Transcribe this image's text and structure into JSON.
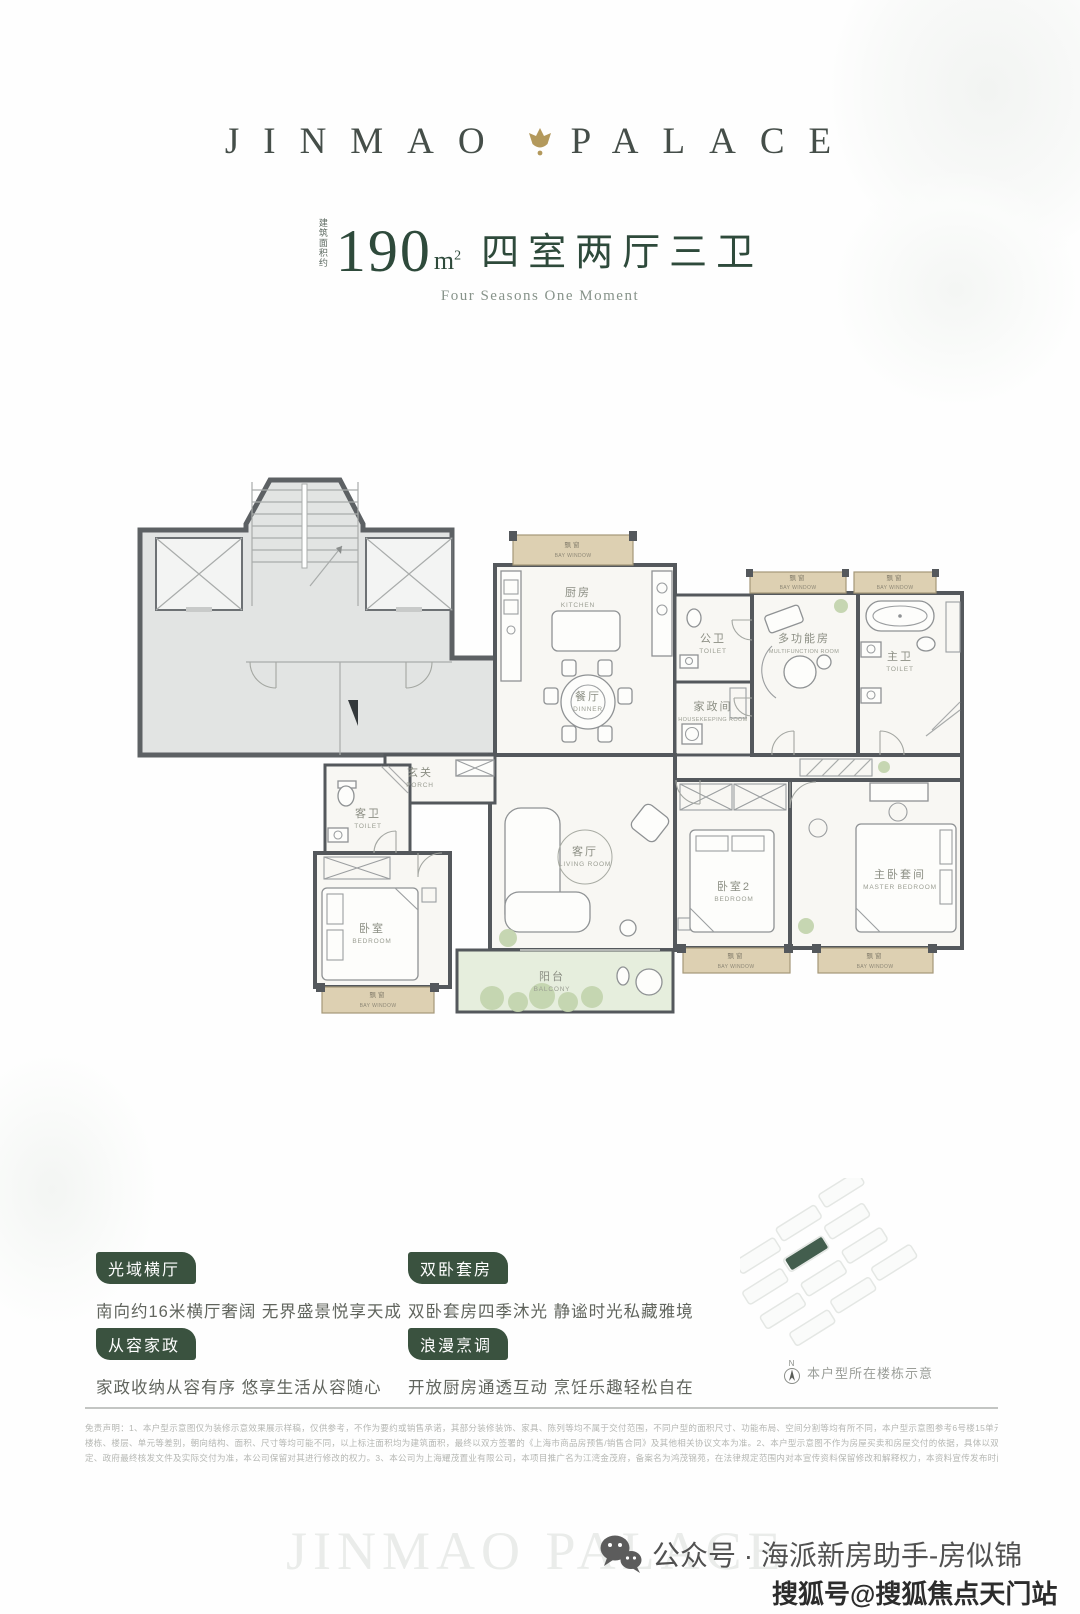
{
  "brand": {
    "name_left": "JINMAO",
    "name_right": "PALACE",
    "watermark": "JINMAO PALACE"
  },
  "header": {
    "area_prefix": "建筑面积约",
    "area_value": "190",
    "area_unit": "m",
    "area_unit_sup": "2",
    "layout_cn": "四室两厅三卫",
    "subtitle_en": "Four Seasons One Moment"
  },
  "floorplan": {
    "rooms": {
      "bay_window": {
        "cn": "飘窗",
        "en": "BAY WINDOW"
      },
      "kitchen": {
        "cn": "厨房",
        "en": "KITCHEN"
      },
      "dinner": {
        "cn": "餐厅",
        "en": "DINNER"
      },
      "guest_toilet": {
        "cn": "公卫",
        "en": "TOILET"
      },
      "housekeeping": {
        "cn": "家政间",
        "en": "HOUSEKEEPING ROOM"
      },
      "multifunction": {
        "cn": "多功能房",
        "en": "MULTIFUNCTION ROOM"
      },
      "master_toilet": {
        "cn": "主卫",
        "en": "TOILET"
      },
      "porch": {
        "cn": "玄关",
        "en": "PORCH"
      },
      "toilet": {
        "cn": "客卫",
        "en": "TOILET"
      },
      "bedroom": {
        "cn": "卧室",
        "en": "BEDROOM"
      },
      "living_room": {
        "cn": "客厅",
        "en": "LIVING ROOM"
      },
      "balcony": {
        "cn": "阳台",
        "en": "BALCONY"
      },
      "bedroom2": {
        "cn": "卧室2",
        "en": "BEDROOM"
      },
      "master_bedroom": {
        "cn": "主卧套间",
        "en": "MASTER BEDROOM"
      }
    }
  },
  "features": [
    {
      "tag": "光域横厅",
      "desc": "南向约16米横厅奢阔 无界盛景悦享天成"
    },
    {
      "tag": "双卧套房",
      "desc": "双卧套房四季沐光 静谧时光私藏雅境"
    },
    {
      "tag": "从容家政",
      "desc": "家政收纳从容有序 悠享生活从容随心"
    },
    {
      "tag": "浪漫烹调",
      "desc": "开放厨房通透互动 烹饪乐趣轻松自在"
    }
  ],
  "locator": {
    "compass_letter": "N",
    "caption": "本户型所在楼栋示意"
  },
  "disclaimer": {
    "line1": "免责声明：1、本户型示意图仅为装修示意效果展示样稿，仅供参考，不作为要约或销售承诺，其部分装修装饰、家具、陈列等均不属于交付范围，不同户型的面积尺寸、功能布局、空间分割等均有所不同，本户型示意图参考6号楼15单元301室，但相同户型因",
    "line2": "楼栋、楼层、单元等差别，朝向结构、面积、尺寸等均可能不同，以上标注面积均为建筑面积，最终以双方签署的《上海市商品房预售/销售合同》及其他相关协议文本为准。2、本户型示意图不作为房屋买卖和房屋交付的依据，具体以双方签署的销售合同约",
    "line3": "定、政府最终核发文件及实际交付为准，本公司保留对其进行修改的权力。3、本公司为上海耀茂置业有限公司，本项目推广名为江湾金茂府，备案名为鸿茂锦苑，在法律规定范围内对本宣传资料保留修改和解释权力，本资料宣传发布时间：2025年12月。"
  },
  "footer": {
    "wechat_label": "公众号 · 海派新房助手-房似锦",
    "sohu_label": "搜狐号@搜狐焦点天门站"
  },
  "colors": {
    "brand_green": "#2e4a3b",
    "tag_green": "#3a523f",
    "gold": "#b3995c",
    "bay_beige": "#ddd0b2",
    "wall_gray": "#54585c"
  }
}
